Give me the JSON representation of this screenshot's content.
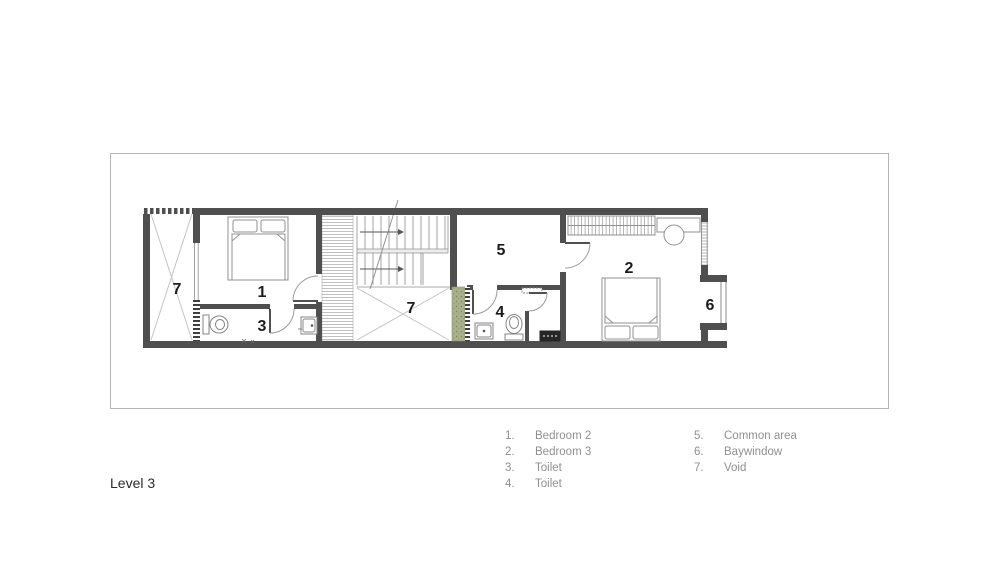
{
  "sheet": {
    "level_label": "Level 3"
  },
  "plan_labels": {
    "void_left": "7",
    "bedroom1_tag": "1",
    "toilet3_tag": "3",
    "void_stair": "7",
    "common_area_tag": "5",
    "toilet4_tag": "4",
    "bedroom2_tag": "2",
    "baywindow_tag": "6"
  },
  "legend": {
    "column1": [
      {
        "num": "1.",
        "label": "Bedroom 2"
      },
      {
        "num": "2.",
        "label": "Bedroom 3"
      },
      {
        "num": "3.",
        "label": "Toilet"
      },
      {
        "num": "4.",
        "label": "Toilet"
      }
    ],
    "column2": [
      {
        "num": "5.",
        "label": "Common area"
      },
      {
        "num": "6.",
        "label": "Baywindow"
      },
      {
        "num": "7.",
        "label": "Void"
      }
    ]
  },
  "colors": {
    "wall": "#4f4f4f",
    "furniture_line": "#8f8f8f",
    "hatch_line": "#b0b0b0",
    "planter_green": "#a9b18c",
    "label_text": "#1c1c1c",
    "legend_text": "#8f8f8f",
    "sheet_border": "#b3b3b3"
  }
}
